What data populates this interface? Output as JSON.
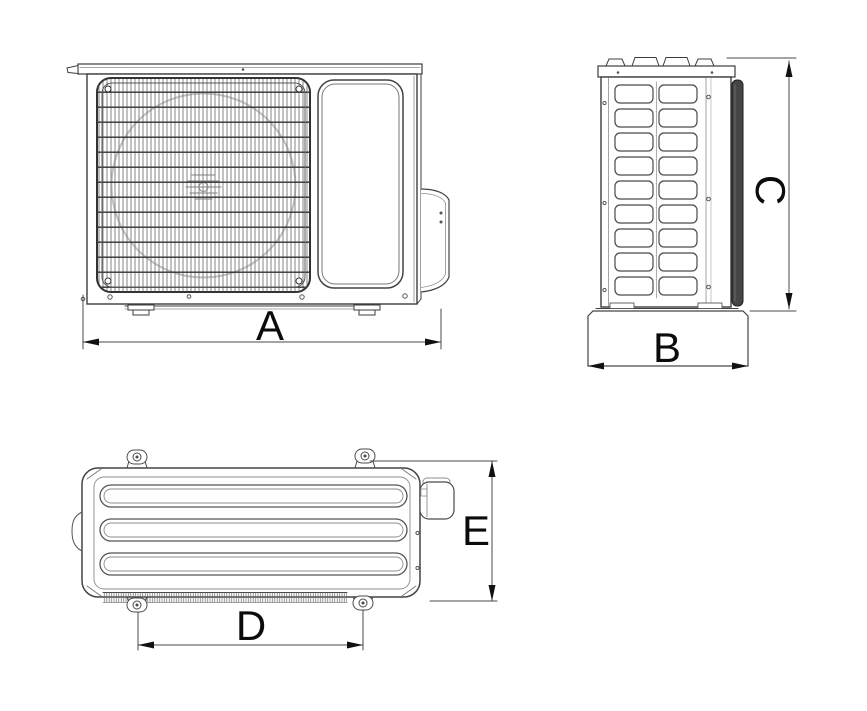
{
  "drawing": {
    "subject": "air-conditioner outdoor unit dimensional drawing",
    "dimensions": {
      "A": {
        "label": "A",
        "view": "front-view",
        "axis": "horizontal",
        "measures": "overall unit width"
      },
      "B": {
        "label": "B",
        "view": "side-view",
        "axis": "horizontal",
        "measures": "base depth"
      },
      "C": {
        "label": "C",
        "view": "side-view",
        "axis": "vertical",
        "measures": "unit height"
      },
      "D": {
        "label": "D",
        "view": "top-view",
        "axis": "horizontal",
        "measures": "mounting hole pitch"
      },
      "E": {
        "label": "E",
        "view": "top-view",
        "axis": "vertical",
        "measures": "unit depth"
      }
    },
    "colors": {
      "background": "#ffffff",
      "outline": "#3d3d3d",
      "outline_light": "#8c8c8c",
      "grille_bar": "#787878",
      "grille_cross": "#333333",
      "coil_fill": "#454545",
      "dimension_line": "#4a4a4a",
      "label_text": "#0b0b0b"
    }
  }
}
